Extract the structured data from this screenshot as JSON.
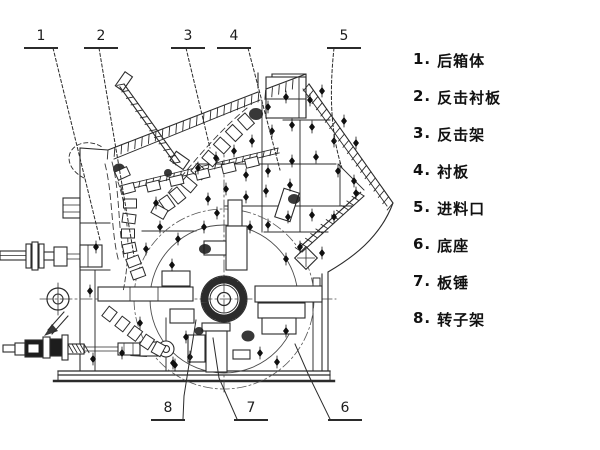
{
  "title": "impact crusher sectional diagram",
  "colors": {
    "background": "#ffffff",
    "line": "#2b2b2b",
    "text": "#111111"
  },
  "legend": {
    "items": [
      {
        "num": "1.",
        "label": "后箱体"
      },
      {
        "num": "2.",
        "label": "反击衬板"
      },
      {
        "num": "3.",
        "label": "反击架"
      },
      {
        "num": "4.",
        "label": "衬板"
      },
      {
        "num": "5.",
        "label": "进料口"
      },
      {
        "num": "6.",
        "label": "底座"
      },
      {
        "num": "7.",
        "label": "板锤"
      },
      {
        "num": "8.",
        "label": "转子架"
      }
    ]
  },
  "callouts": {
    "top": [
      {
        "num": "1"
      },
      {
        "num": "2"
      },
      {
        "num": "3"
      },
      {
        "num": "4"
      },
      {
        "num": "5"
      }
    ],
    "bottom": [
      {
        "num": "8"
      },
      {
        "num": "7"
      },
      {
        "num": "6"
      }
    ]
  }
}
